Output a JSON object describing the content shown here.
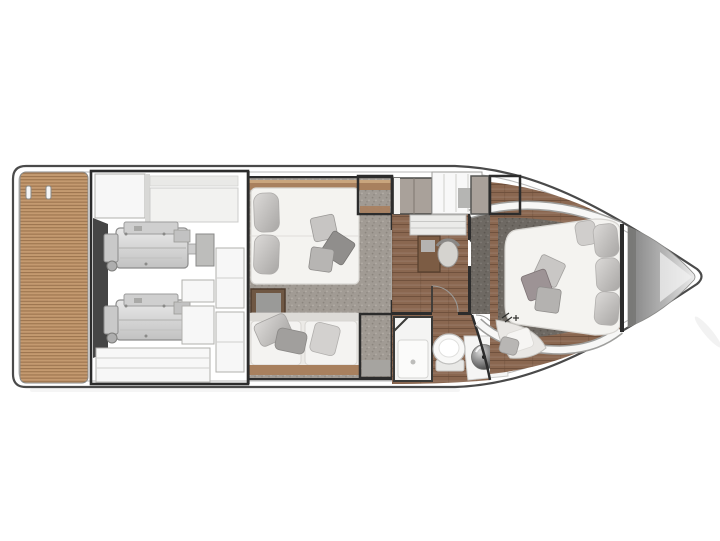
{
  "plan": {
    "type": "yacht-lower-deck-floor-plan",
    "orientation": "bow-right",
    "rooms": [
      {
        "id": "swim-platform",
        "features": [
          "teak-decking",
          "mooring-cleats"
        ]
      },
      {
        "id": "engine-room",
        "features": [
          "port-engine",
          "starboard-engine",
          "equipment-cabinets",
          "tanks"
        ]
      },
      {
        "id": "guest-cabin",
        "features": [
          "double-berth",
          "berth-pillows",
          "scatter-cushions",
          "nightstand",
          "sofa",
          "hanging-wardrobes",
          "carpet"
        ]
      },
      {
        "id": "companionway",
        "features": [
          "stairs",
          "storage-cabinet",
          "desk",
          "chair",
          "doors",
          "wood-floor"
        ]
      },
      {
        "id": "head-compartment",
        "features": [
          "shower-cubicle",
          "toilet",
          "washbasin",
          "vanity-counter"
        ]
      },
      {
        "id": "master-cabin",
        "features": [
          "island-berth",
          "berth-pillows",
          "scatter-cushions",
          "settee",
          "hanging-wardrobe",
          "carpet"
        ]
      },
      {
        "id": "bow-locker",
        "features": [
          "anchor-locker"
        ]
      }
    ]
  },
  "colors": {
    "c_hull_stroke": "#4a4a4a",
    "c_hull_inner": "#b9b9b9",
    "c_wall": "#2c2c2c",
    "c_teak_base": "#c49a70",
    "c_teak_line": "#9c744e",
    "c_wood_base": "#8a6750",
    "c_wood_line": "#6b4e3a",
    "c_wood_trim": "#a8805e",
    "c_carpet_mid": "#a19b94",
    "c_carpet_mid_dot": "#8b857e",
    "c_carpet_mid_hi": "#b3ada6",
    "c_carpet_dark": "#6e6963",
    "c_carpet_dark_dot": "#5b5650",
    "c_carpet_dark_hi": "#7f7a74",
    "c_bed": "#f4f3f0",
    "c_pillow_light": "#dcdad8",
    "c_pillow_dark": "#a8a6a4",
    "c_hatch_bg": "#efede9",
    "c_hatch_line": "#2b2b2b",
    "c_engine_light": "#e8e8e8",
    "c_engine_dark": "#c2c2c2",
    "c_equipment": "#f7f7f7",
    "c_shadow_band": "#454545",
    "c_taupe": "#a9a19a",
    "c_fixture_white": "#f8f8f7",
    "c_bow_dark": "#828282",
    "c_bow_mid": "#b5b5b5",
    "c_bow_light": "#ededed",
    "c_sink_hi": "#d9d9d9",
    "c_sink_mid": "#8a8a8a",
    "c_sink_dark": "#2e2e2e"
  }
}
